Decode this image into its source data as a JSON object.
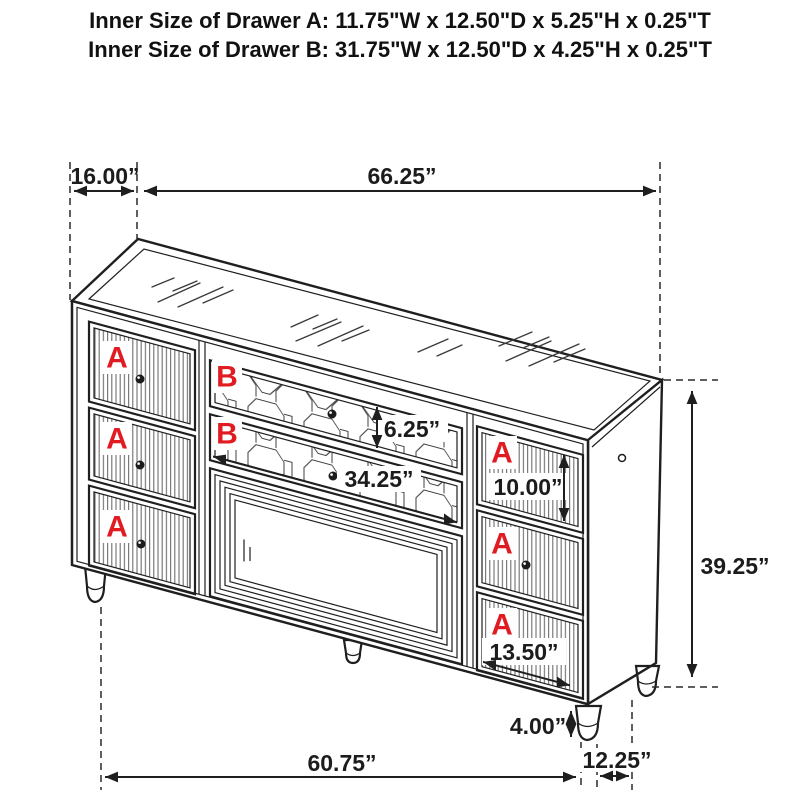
{
  "header": {
    "line1": "Inner Size of Drawer A: 11.75\"W x 12.50\"D x 5.25\"H x 0.25\"T",
    "line2": "Inner Size of Drawer B: 31.75\"W x 12.50\"D x 4.25\"H x 0.25\"T"
  },
  "dims": {
    "left_depth": "16.00”",
    "total_width": "66.25”",
    "drawer_b_height": "6.25”",
    "drawer_b_width": "34.25”",
    "drawer_a_right_height": "10.00”",
    "total_height": "39.25”",
    "drawer_a_right_width": "13.50”",
    "leg_height": "4.00”",
    "front_width": "60.75”",
    "side_depth": "12.25”"
  },
  "labels": {
    "a": "A",
    "b": "B"
  },
  "colors": {
    "line": "#1f1f1f",
    "label_red": "#e11b22",
    "background": "#ffffff"
  }
}
